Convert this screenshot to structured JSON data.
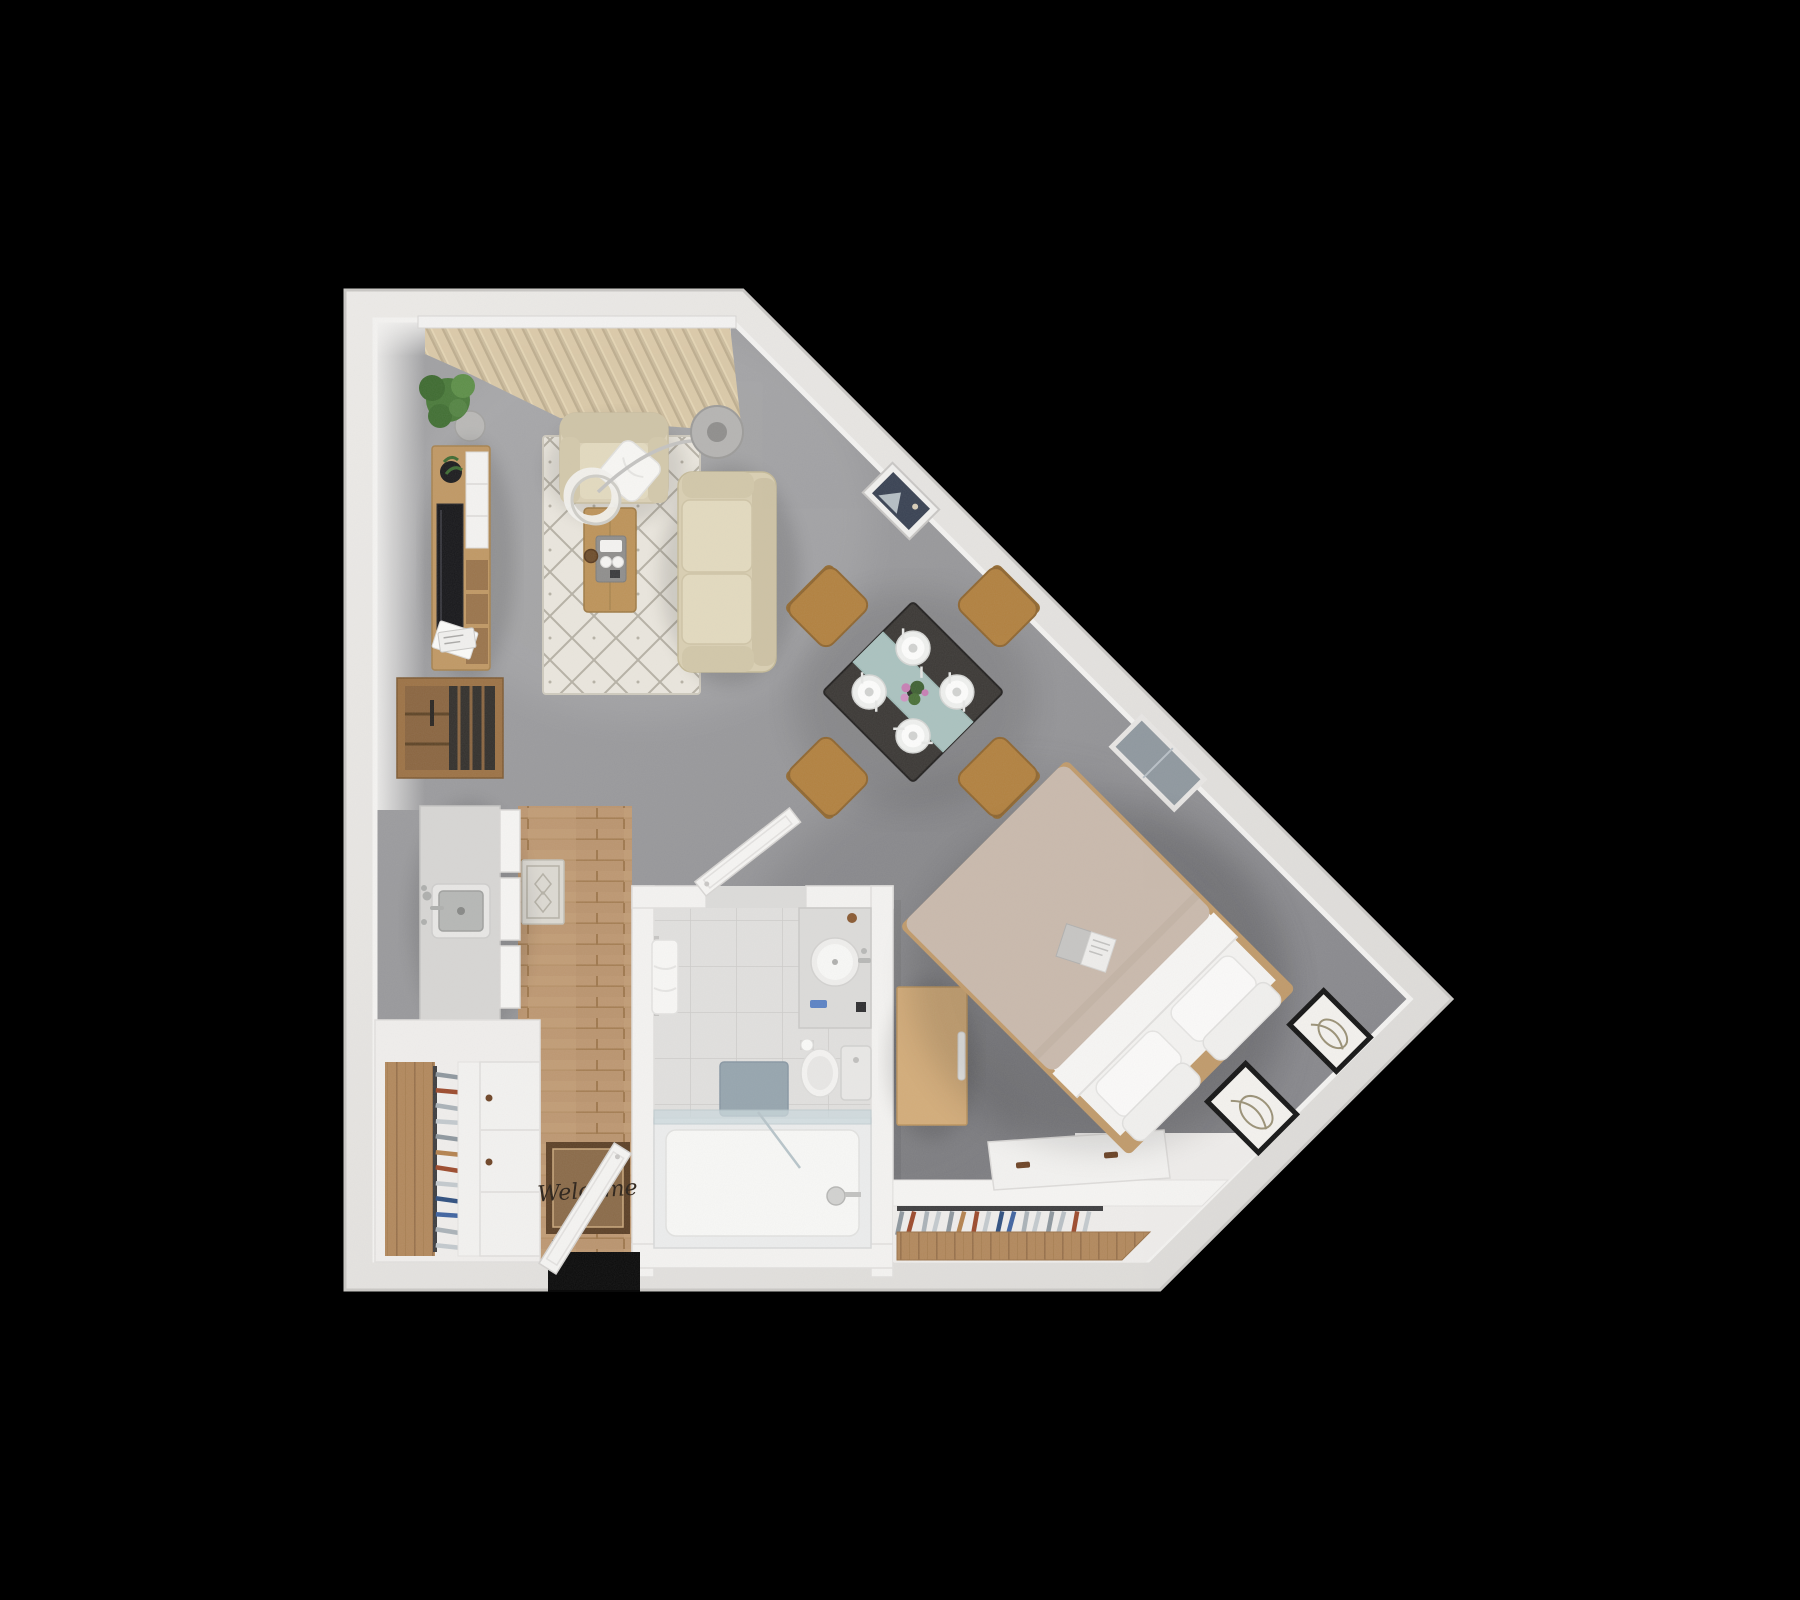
{
  "scene": {
    "type": "3d-floor-plan-top-down",
    "description": "Studio apartment 3D floor plan render on black background",
    "background_color": "#000000"
  },
  "palette": {
    "outer_wall": "#e9e7e4",
    "inner_wall_face": "#f4f3f1",
    "floor_gray_light": "#a0a0a2",
    "floor_gray_dark": "#85858a",
    "wood_floor": "#c8a078",
    "closet_wood": "#b2885c",
    "rug": "#eae6dd",
    "rug_lattice": "#b6b1a5",
    "tile": "#e1e0de",
    "sofa": "#d9cfb2",
    "armchair": "#dbd1b6",
    "cushion": "#e3dabf",
    "pillow_white": "#f8f7f4",
    "curtain": "#d5c4a1",
    "plant_green": "#4a7a3a",
    "furniture_wood": "#c09864",
    "coffee_table_wood": "#bd9359",
    "chair_wood": "#b2813f",
    "dining_table_top": "#3b3835",
    "table_runner_glass": "#b7d2ce",
    "bed_duvet": "#c9b9ac",
    "bed_sheet": "#f4f3f1",
    "bed_frame_wood": "#c09a6a",
    "dresser_wood": "#d3ac79",
    "bath_mat": "#93a2ac",
    "doormat": "#8a6a48",
    "doormat_border": "#5c4026",
    "window_glass": "#8f989f",
    "tv_screen": "#17171a"
  },
  "entry": {
    "doormat_text": "Welcome"
  },
  "rooms": [
    "living-dining-area",
    "sleeping-area",
    "kitchen",
    "bathroom",
    "entry",
    "closets"
  ],
  "furniture": [
    "window-curtains",
    "potted-plant",
    "media-console",
    "flat-screen-tv",
    "magazines",
    "record-shelf",
    "area-rug",
    "armchair",
    "throw-pillow",
    "arc-floor-lamp",
    "paper-lantern-lamp",
    "loveseat-sofa",
    "coffee-table",
    "serving-tray",
    "dining-table",
    "dining-chairs",
    "place-settings",
    "wall-art-frame",
    "diagonal-window",
    "kitchen-counter",
    "kitchen-sink",
    "kitchen-runner-rug",
    "pantry-cabinets",
    "wardrobe-with-hangers",
    "welcome-doormat",
    "entry-door",
    "bathroom-door",
    "bathroom-vanity",
    "toilet",
    "towel-rack",
    "bath-mat",
    "walk-in-shower",
    "bedroom-dresser",
    "sliding-closet-door",
    "closet-rail-hangers",
    "double-bed",
    "bed-pillows",
    "open-book",
    "leaning-art-frames"
  ],
  "counts": {
    "dining_chairs": 4,
    "place_settings": 4,
    "bed_pillows": 4,
    "leaning_frames": 2,
    "closet_hangers": 16,
    "entry_closet_hangers": 12
  },
  "closet": {
    "hanger_colors": [
      "#8e979e",
      "#9c4a2c",
      "#aab2b8",
      "#c3c9cd",
      "#8e979e",
      "#b4824e",
      "#9c4a2c",
      "#c3c9cd",
      "#2f4f7f",
      "#3f63a0",
      "#aab2b8",
      "#c3c9cd",
      "#8e979e",
      "#b8bfc4",
      "#9c4a2c",
      "#c3c9cd"
    ]
  }
}
